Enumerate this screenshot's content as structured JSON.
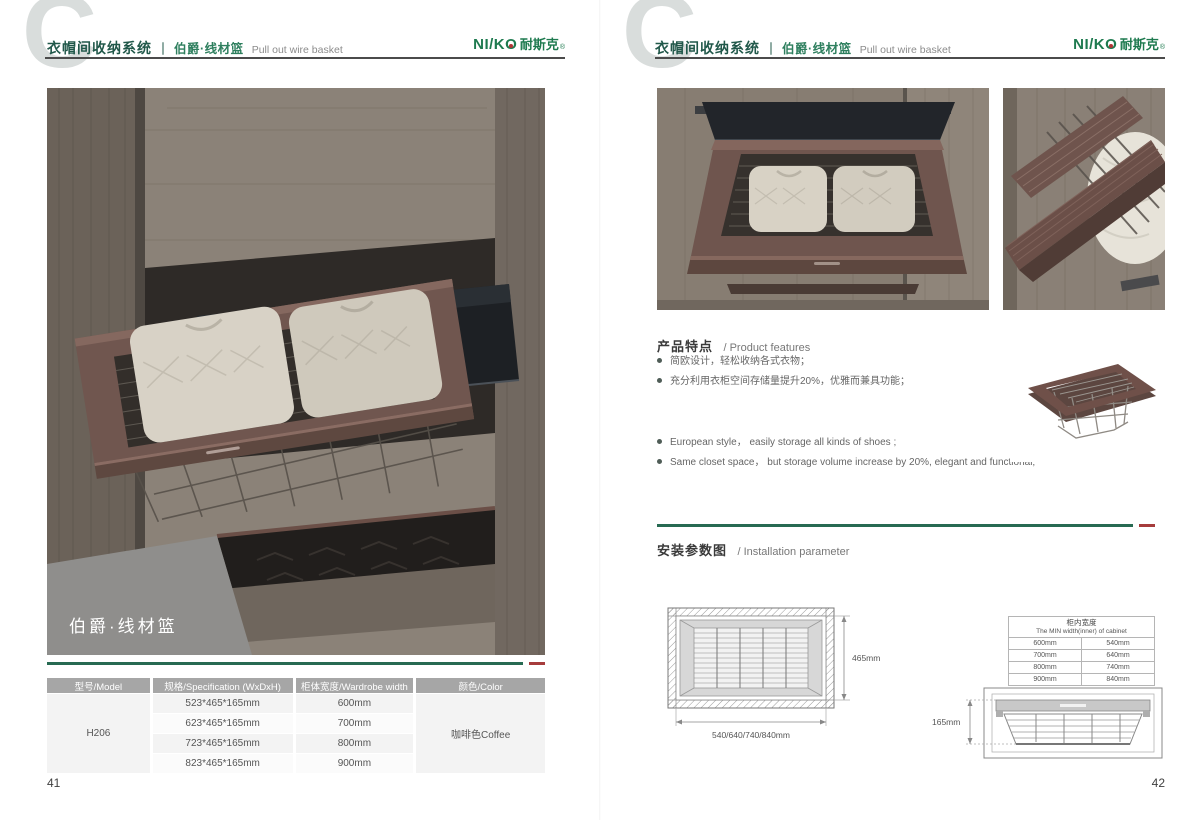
{
  "brand": {
    "logo_prefix": "NI/K",
    "logo_o": "O",
    "logo_cn": "耐斯克",
    "reg": "®"
  },
  "header": {
    "watermark": "C",
    "system_cn": "衣帽间收纳系统",
    "divider": "｜",
    "product_cn": "伯爵·线材篮",
    "product_en": "Pull out wire basket"
  },
  "left_page": {
    "photo_caption": "伯爵·线材篮",
    "page_number": "41",
    "spec_table": {
      "col_model": "型号/Model",
      "col_spec": "规格/Specification (WxDxH)",
      "col_width": "柜体宽度/Wardrobe width",
      "col_color": "颜色/Color",
      "model": "H206",
      "color": "咖啡色Coffee",
      "rows": [
        {
          "spec": "523*465*165mm",
          "width": "600mm"
        },
        {
          "spec": "623*465*165mm",
          "width": "700mm"
        },
        {
          "spec": "723*465*165mm",
          "width": "800mm"
        },
        {
          "spec": "823*465*165mm",
          "width": "900mm"
        }
      ]
    }
  },
  "right_page": {
    "page_number": "42",
    "features": {
      "heading_cn": "产品特点",
      "heading_en": "/ Product features",
      "bullets_cn": [
        "简欧设计，轻松收纳各式衣物；",
        "充分利用衣柜空间存储量提升20%，优雅而兼具功能；"
      ],
      "bullets_en": [
        "European style， easily storage all kinds of shoes ;",
        "Same closet space， but storage volume increase by 20%, elegant and functional;"
      ]
    },
    "installation": {
      "heading_cn": "安装参数图",
      "heading_en": "/ Installation parameter",
      "top_view": {
        "depth_label": "465mm",
        "width_label": "540/640/740/840mm"
      },
      "min_width_table": {
        "title_cn": "柜内宽度",
        "title_en": "The MIN width(inner) of cabinet",
        "rows": [
          [
            "600mm",
            "540mm"
          ],
          [
            "700mm",
            "640mm"
          ],
          [
            "800mm",
            "740mm"
          ],
          [
            "900mm",
            "840mm"
          ]
        ]
      },
      "side_view": {
        "height_label": "165mm"
      }
    },
    "colors": {
      "accent_green": "#276a52",
      "accent_red": "#a63c3c",
      "logo_green": "#1e7a4f",
      "frame_coffee": "#6f554e"
    }
  }
}
